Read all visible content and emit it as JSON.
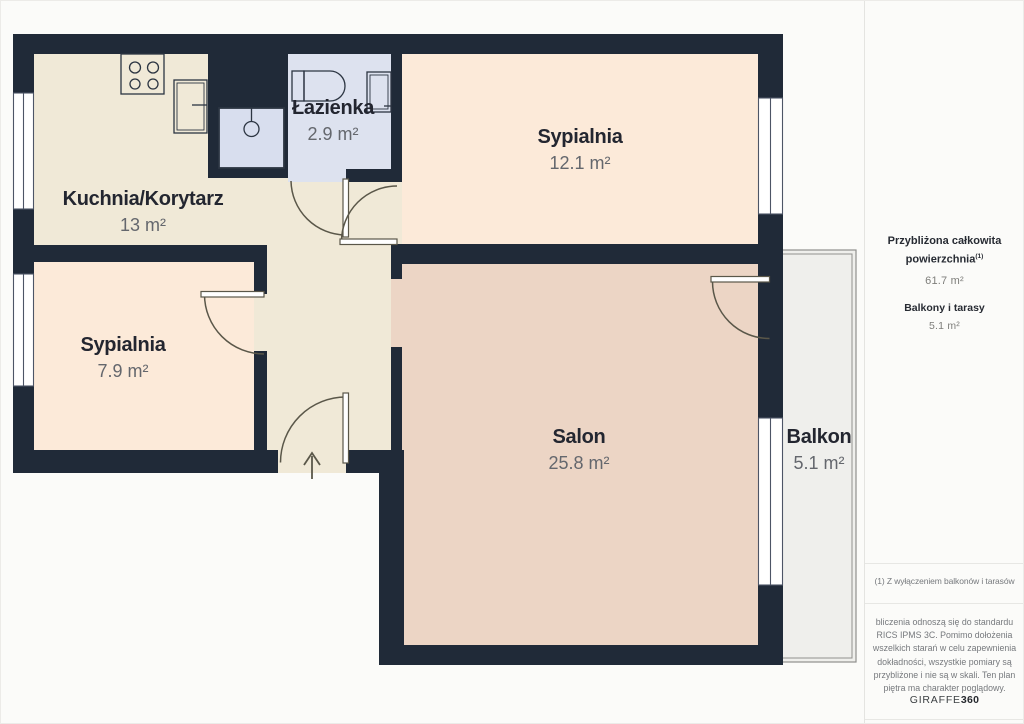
{
  "plan": {
    "rooms": [
      {
        "id": "kuchnia-korytarz",
        "name": "Kuchnia/Korytarz",
        "area": "13 m²"
      },
      {
        "id": "lazienka",
        "name": "Łazienka",
        "area": "2.9 m²"
      },
      {
        "id": "sypialnia-duza",
        "name": "Sypialnia",
        "area": "12.1 m²"
      },
      {
        "id": "sypialnia-mala",
        "name": "Sypialnia",
        "area": "7.9 m²"
      },
      {
        "id": "salon",
        "name": "Salon",
        "area": "25.8 m²"
      },
      {
        "id": "balkon",
        "name": "Balkon",
        "area": "5.1 m²"
      }
    ],
    "colors": {
      "wall": "#202a38",
      "kitchen_floor": "#f0e9d7",
      "bedroom_floor": "#fcead9",
      "salon_floor": "#ecd5c5",
      "bathroom_floor": "#dde2ef",
      "shower_fill": "#d8deee",
      "balcony_floor": "#efefec",
      "balcony_stroke": "#90908e",
      "window_stroke": "#4d5566",
      "door_stroke": "#5a5749",
      "fixture_stroke": "#2c3542"
    }
  },
  "sidebar": {
    "total_label_line1": "Przybliżona całkowita",
    "total_label_line2": "powierzchnia",
    "total_footnote_marker": "(1)",
    "total_value": "61.7 m²",
    "balcony_label": "Balkony i tarasy",
    "balcony_value": "5.1 m²",
    "footnote": "(1) Z wyłączeniem balkonów i tarasów",
    "disclaimer": "bliczenia odnoszą się do standardu RICS IPMS 3C. Pomimo dołożenia wszelkich starań w celu zapewnienia dokładności, wszystkie pomiary są przybliżone i nie są w skali. Ten plan piętra ma charakter poglądowy.",
    "brand_name": "GIRAFFE",
    "brand_suffix": "360"
  }
}
